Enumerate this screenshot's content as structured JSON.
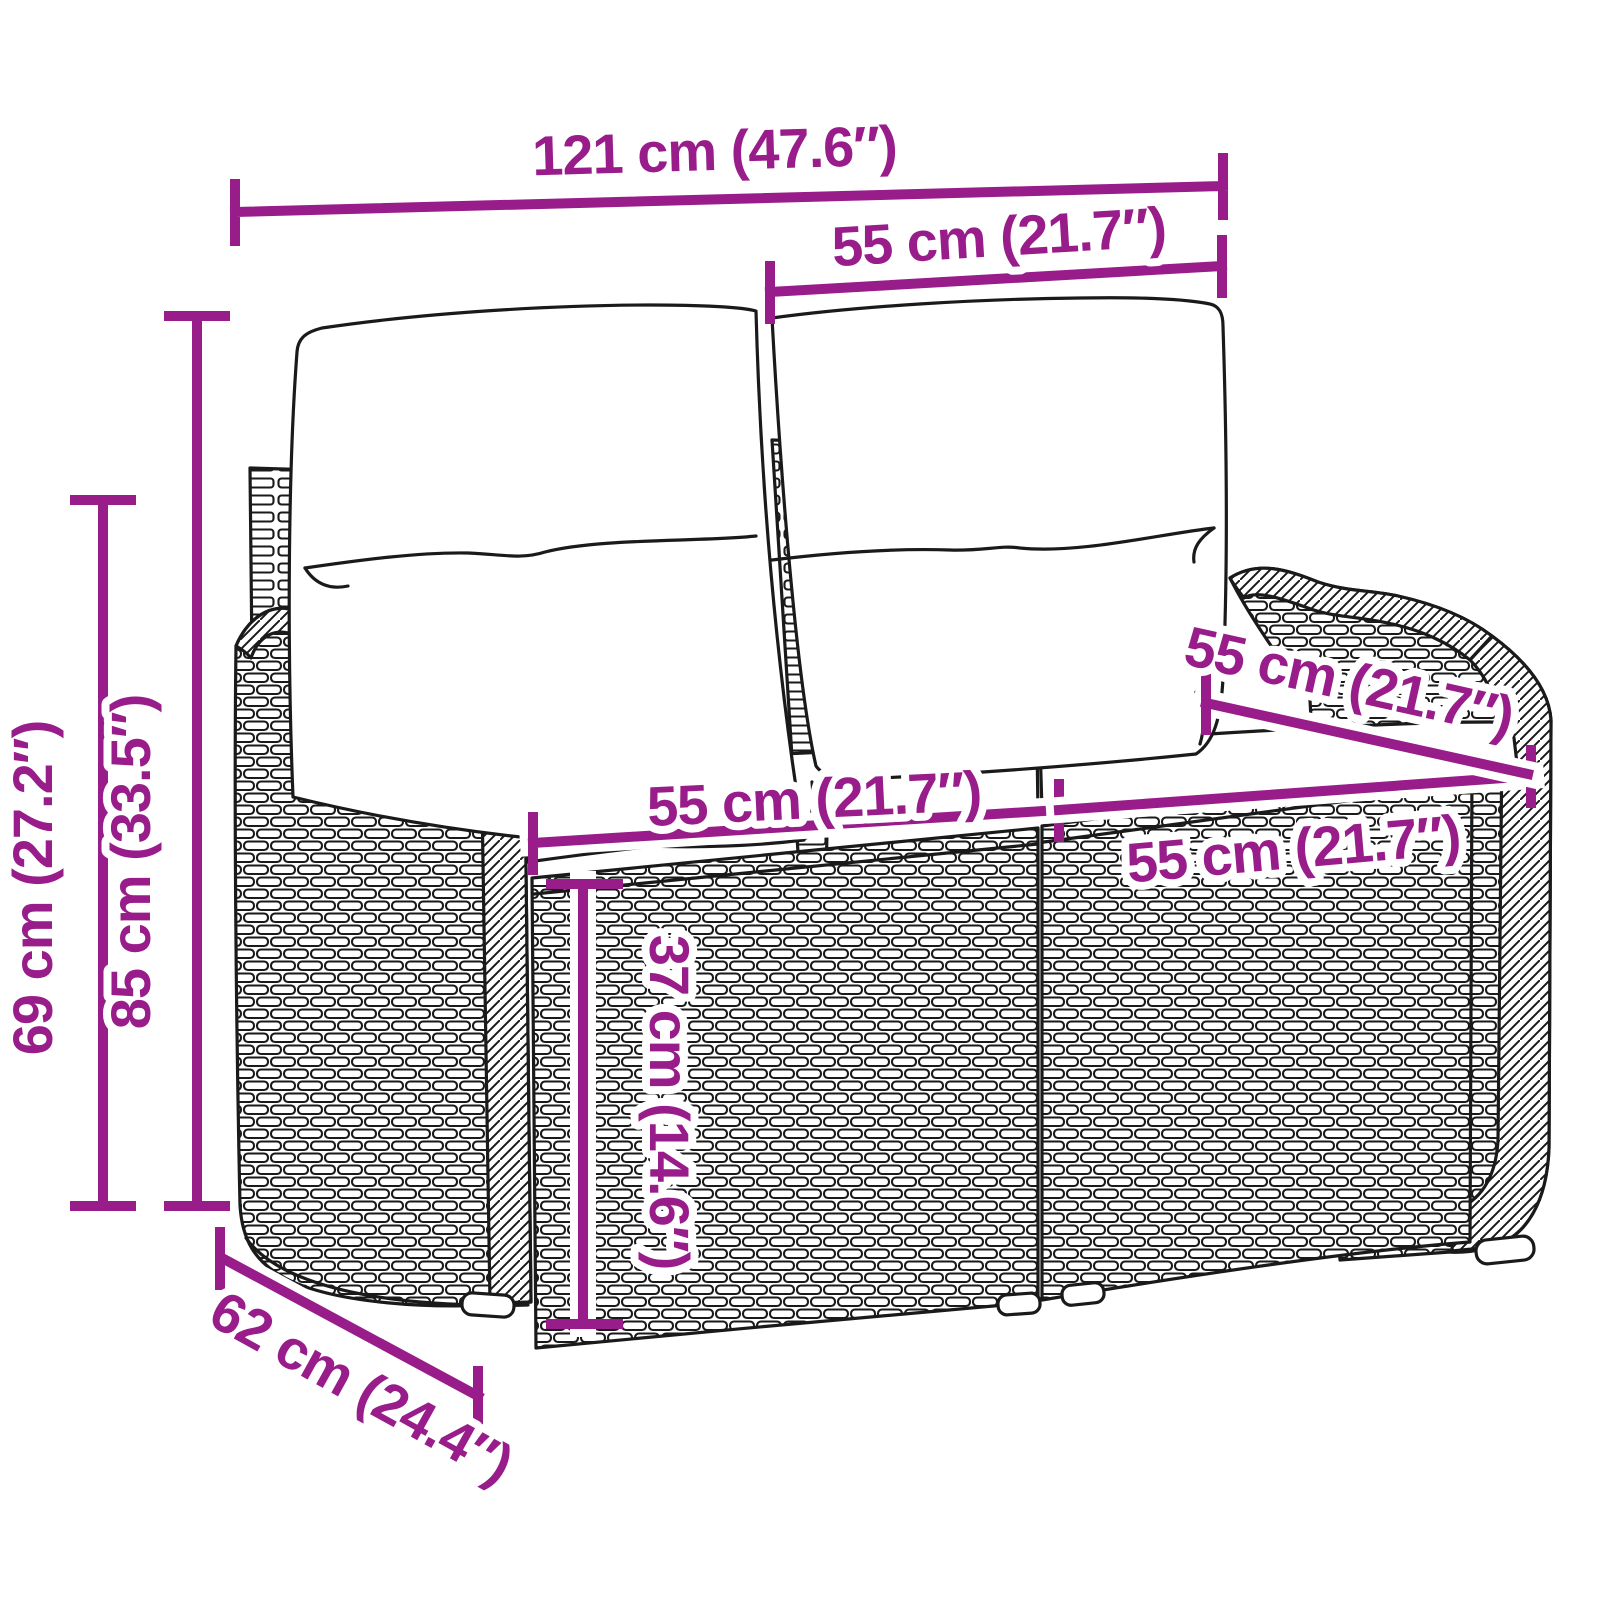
{
  "diagram": {
    "type": "product-dimension-diagram",
    "subject": "poly rattan 2-seater garden bench with back and seat cushions",
    "colors": {
      "dimension_accent": "#981C89",
      "line_art": "#1a1a1a",
      "background": "#ffffff"
    },
    "labels": {
      "overall_width": "121 cm (47.6″)",
      "back_section_width": "55 cm (21.7″)",
      "armrest_height": "69 cm (27.2″)",
      "total_height": "85 cm (33.5″)",
      "seat_width_left": "55 cm (21.7″)",
      "seat_depth": "55 cm (21.7″)",
      "seat_width_right": "55 cm (21.7″)",
      "seat_height": "37 cm (14.6″)",
      "overall_depth": "62 cm (24.4″)"
    }
  }
}
